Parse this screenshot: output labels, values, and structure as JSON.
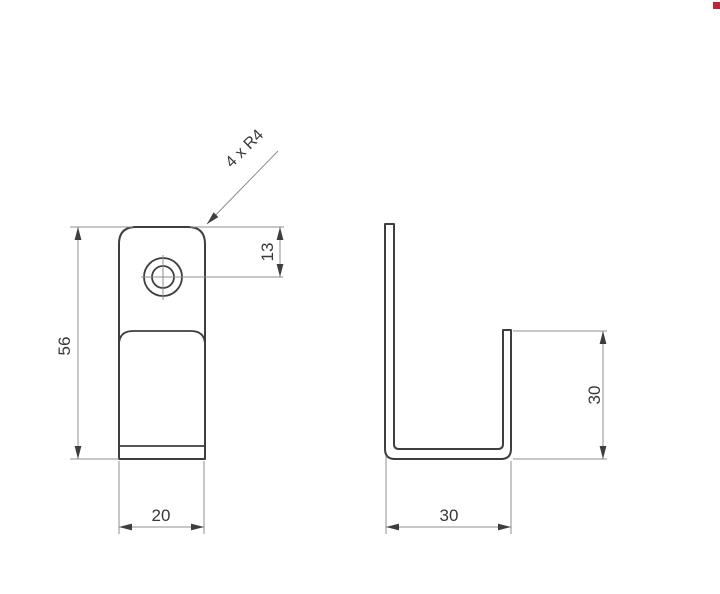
{
  "drawing": {
    "type": "technical-drawing-two-views",
    "front_view": {
      "height_label": "56",
      "width_label": "20",
      "hole_offset_label": "13",
      "corner_radius_label": "4 x R4"
    },
    "side_view": {
      "hook_height_label": "30",
      "depth_label": "30"
    },
    "colors": {
      "background": "#ffffff",
      "outline": "#3e3e3e",
      "dimension_lines": "#8f8f8f",
      "text": "#383838",
      "watermark_red": "#c0243a"
    }
  }
}
